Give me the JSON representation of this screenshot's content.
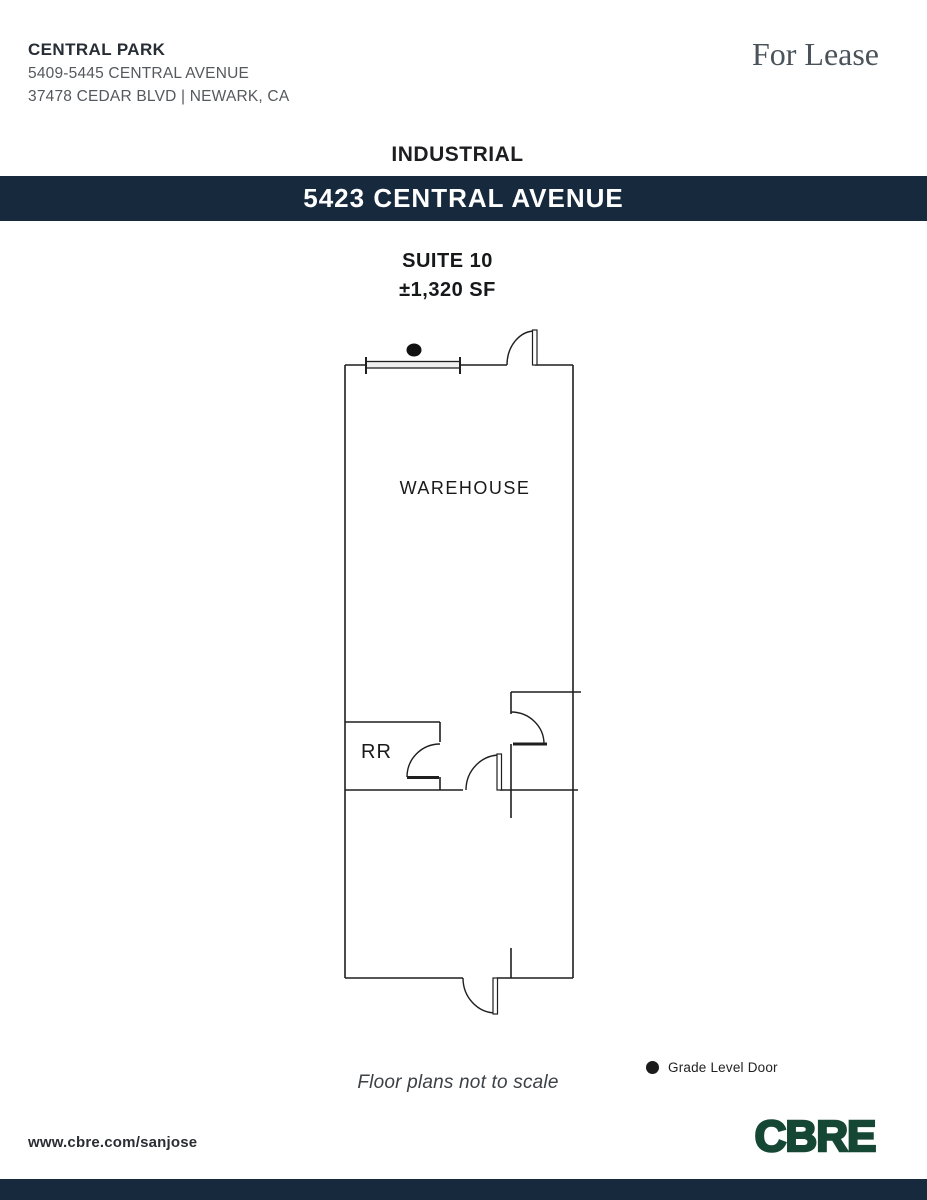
{
  "header": {
    "property_name": "CENTRAL PARK",
    "address_line1": "5409-5445 CENTRAL AVENUE",
    "address_line2": "37478 CEDAR BLVD |  NEWARK, CA",
    "lease_status": "For Lease"
  },
  "property_type": "INDUSTRIAL",
  "banner": {
    "title": "5423 CENTRAL AVENUE",
    "bg_color": "#16293d",
    "text_color": "#ffffff"
  },
  "suite": {
    "name": "SUITE 10",
    "size": "±1,320 SF"
  },
  "floor_plan": {
    "rooms": [
      {
        "label": "WAREHOUSE"
      },
      {
        "label": "RR"
      }
    ],
    "note": "Floor plans not to scale",
    "legend": [
      {
        "symbol": "grade-level-door-dot",
        "label": "Grade Level Door"
      }
    ],
    "line_color": "#1f1f1f"
  },
  "footer": {
    "website": "www.cbre.com/sanjose",
    "brand": "CBRE",
    "brand_color": "#154734",
    "bar_color": "#16293d"
  }
}
